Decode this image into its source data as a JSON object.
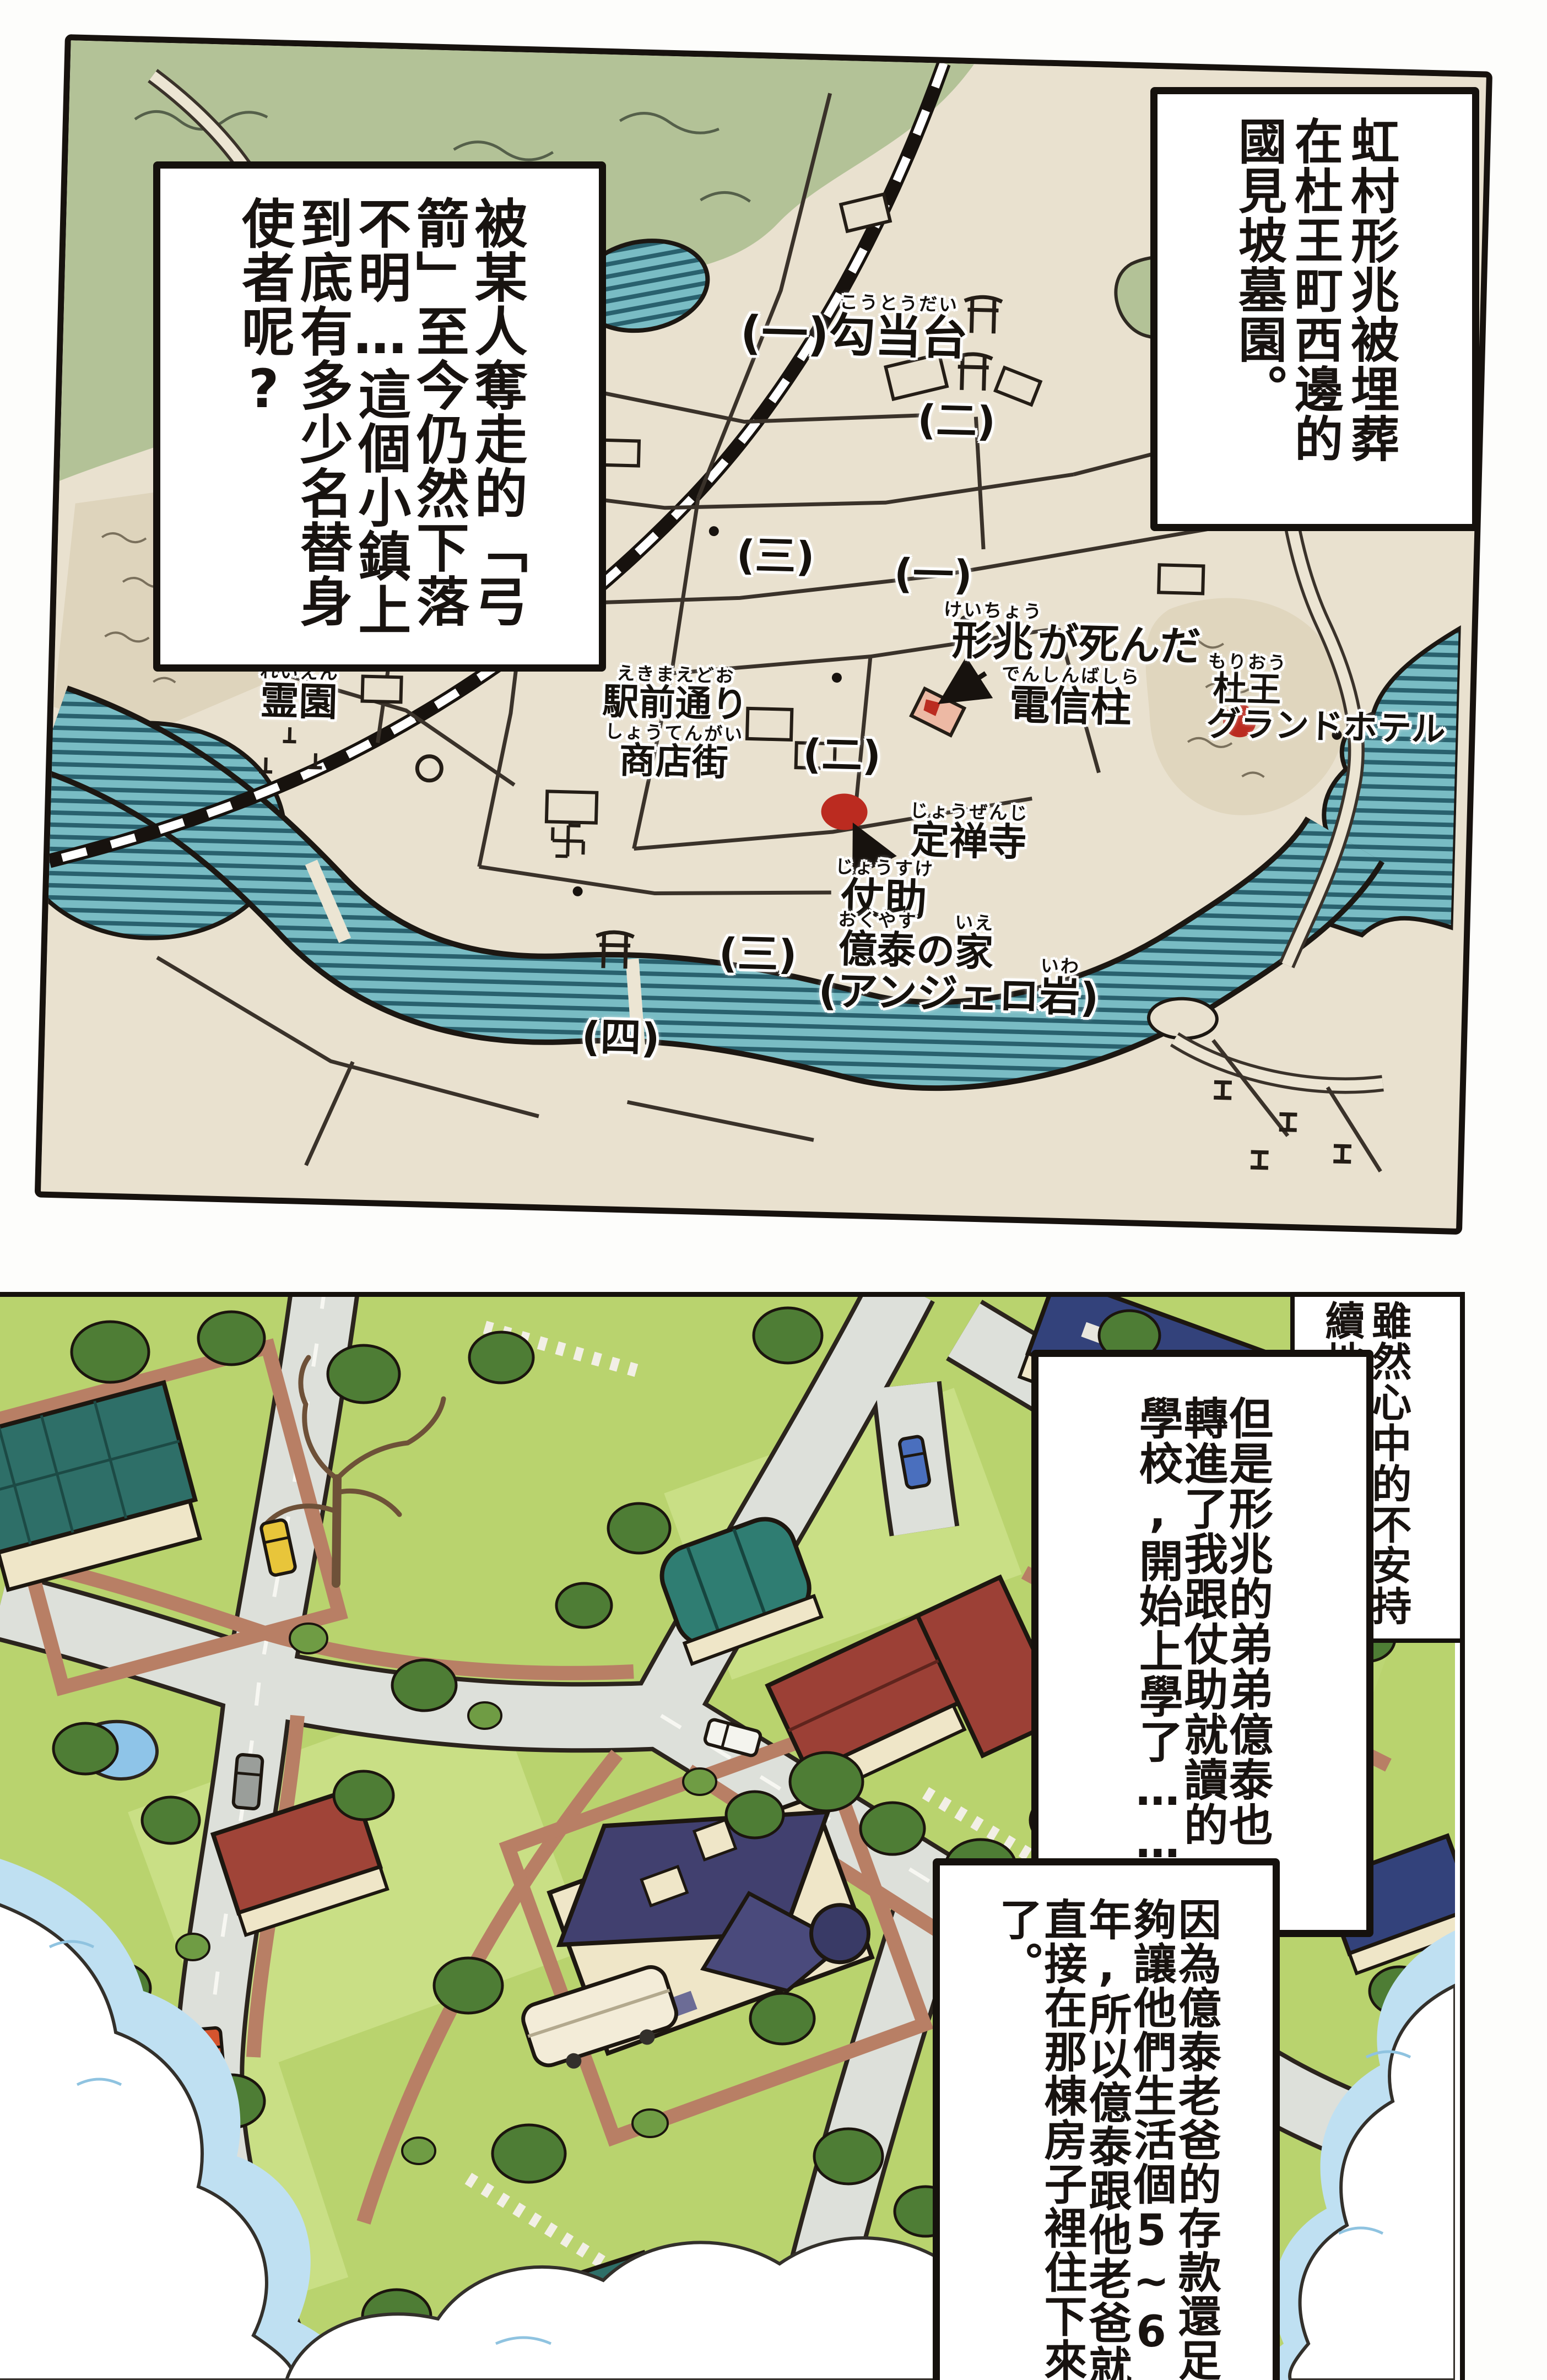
{
  "narration": {
    "top_right": "虹村形兆被埋葬在杜王町西邊的國見坡墓園。",
    "top_left": "被某人奪走的「弓箭」至今仍然下落不明…這個小鎮上到底有多少名替身使者呢?",
    "panel2_intro": "雖然心中的不安持續地擴大……",
    "panel2_school": "但是形兆的弟弟億泰也轉進了我跟仗助就讀的學校,開始上學了……",
    "panel2_house": "因為億泰老爸的存款還足夠讓他們生活個5~6年,所以億泰跟他老爸就直接在那棟房子裡住下來了。"
  },
  "map": {
    "labels": {
      "kotodai": {
        "num": "(一)",
        "base": "勾当台",
        "kana": "こうとうだい"
      },
      "keicho": {
        "base": "形兆",
        "kana": "けいちょう",
        "rest": "が死んだ",
        "line2_base": "電信柱",
        "line2_kana": "でんしんばしら"
      },
      "hotel": {
        "base": "杜王",
        "kana": "もりおう",
        "line2": "グランドホテル"
      },
      "reien": {
        "base": "霊園",
        "kana": "れいえん"
      },
      "ekimae": {
        "base": "駅前通り",
        "kana": "えきまえどお",
        "line2_base": "商店街",
        "line2_kana": "しょうてんがい"
      },
      "jozenji": {
        "base": "定禅寺",
        "kana": "じょうぜんじ"
      },
      "josuke": {
        "base": "仗助",
        "kana": "じょうすけ"
      },
      "okuyasu": {
        "base": "億泰",
        "kana": "おくやす",
        "no": "の",
        "ie_base": "家",
        "ie_kana": "いえ"
      },
      "angelo": {
        "open": "(アンジェロ",
        "base": "岩",
        "kana": "いわ",
        "close": ")"
      },
      "districts": [
        "(二)",
        "(三)",
        "(一)",
        "(二)",
        "(三)",
        "(四)"
      ]
    },
    "markers": {
      "red_dot_count": 2,
      "color": "#bb2b20"
    }
  },
  "palette": {
    "map_land": "#e9e1cf",
    "map_forest": "#b3c297",
    "map_water": "#79bcc4",
    "map_water_stripe": "#29616e",
    "marker_red": "#bb2b20",
    "ink": "#17120e",
    "grass": "#b9d36e",
    "lawn_light": "#c9df85",
    "road_gray": "#dde0da",
    "sidewalk_salmon": "#b87f65",
    "roof_teal": "#2e6f68",
    "roof_blue": "#33427b",
    "roof_red": "#9c4036",
    "roof_mansion": "#41406f",
    "wall_cream": "#efe6c8",
    "sky_blue": "#bfe0f2",
    "tree_green": "#4e7d35"
  }
}
